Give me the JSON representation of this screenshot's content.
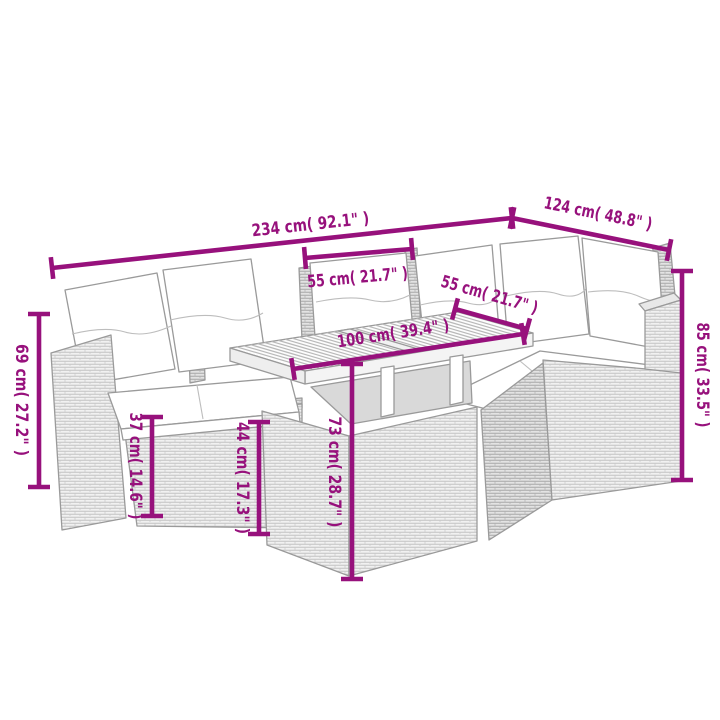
{
  "diagram": {
    "kind": "product-dimension-diagram",
    "subject": "rattan-garden-lounge-set-with-acacia-table",
    "background_color": "#ffffff",
    "accent_color": "#97117C",
    "wicker_color": "#f1f1f1",
    "wicker_shade_color": "#e3e3e3",
    "outline_color": "#9a9a9a",
    "cushion_color": "#ffffff",
    "labels": {
      "sofa_total_width": "234 cm( 92.1\" )",
      "corner_section_width": "124 cm( 48.8\" )",
      "seat_width": "55 cm( 21.7\" )",
      "table_depth": "55 cm( 21.7\" )",
      "table_length": "100 cm( 39.4\" )",
      "armrest_height_left": "69 cm( 27.2\" )",
      "seat_base_height": "37 cm( 14.6\" )",
      "seat_cushion_height": "44 cm( 17.3\" )",
      "table_height": "73 cm( 28.7\" )",
      "backrest_height_right": "85 cm( 33.5\" )"
    }
  }
}
